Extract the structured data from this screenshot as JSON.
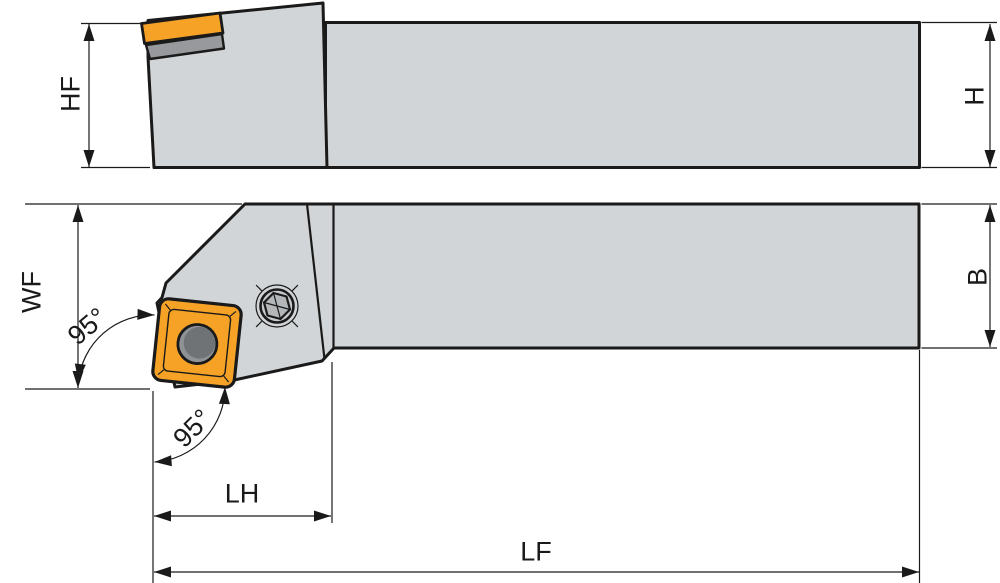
{
  "drawing": {
    "description": "Engineering drawing of a 95-degree lead angle lathe turning tool holder with square indexable insert, shown in side elevation and plan views with dimension callouts",
    "side_view": {
      "hf_label": "HF",
      "h_label": "H"
    },
    "top_view": {
      "wf_label": "WF",
      "b_label": "B",
      "lh_label": "LH",
      "lf_label": "LF",
      "angle_upper": "95°",
      "angle_lower": "95°"
    }
  },
  "colors": {
    "page_bg": "#ffffff",
    "outline": "#1a1a1a",
    "body_gray": "#d2d5d7",
    "shim_gray": "#97999c",
    "insert_orange": "#f5a226",
    "hole_gray_outer": "#8f9294",
    "hole_gray_inner": "#6f7376",
    "screw_ring_fill": "#c6c9cb",
    "hex_fill": "#b4b7b9"
  }
}
